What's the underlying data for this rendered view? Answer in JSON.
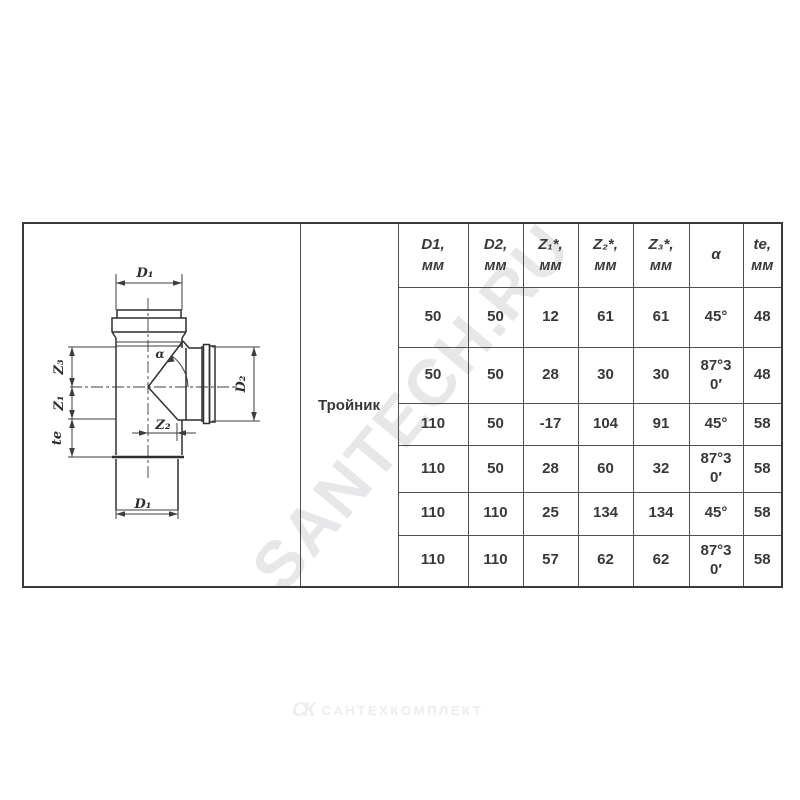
{
  "watermark": {
    "text": "SANTECH.RU",
    "color": "#e7e7ea"
  },
  "logo": {
    "glyph": "СК",
    "text": "САНТЕХКОМПЛЕКТ",
    "color": "#ededed"
  },
  "table": {
    "product_label": "Тройник",
    "columns": [
      {
        "key": "d1",
        "line1": "D1,",
        "line2": "мм"
      },
      {
        "key": "d2",
        "line1": "D2,",
        "line2": "мм"
      },
      {
        "key": "z1",
        "line1": "Z₁*,",
        "line2": "мм"
      },
      {
        "key": "z2",
        "line1": "Z₂*,",
        "line2": "мм"
      },
      {
        "key": "z3",
        "line1": "Z₃*,",
        "line2": "мм"
      },
      {
        "key": "alpha",
        "line1": "α",
        "line2": ""
      },
      {
        "key": "te",
        "line1": "te,",
        "line2": "мм"
      }
    ],
    "rows": [
      [
        "50",
        "50",
        "12",
        "61",
        "61",
        "45°",
        "48"
      ],
      [
        "50",
        "50",
        "28",
        "30",
        "30",
        "87°30′",
        "48"
      ],
      [
        "110",
        "50",
        "-17",
        "104",
        "91",
        "45°",
        "58"
      ],
      [
        "110",
        "50",
        "28",
        "60",
        "32",
        "87°30′",
        "58"
      ],
      [
        "110",
        "110",
        "25",
        "134",
        "134",
        "45°",
        "58"
      ],
      [
        "110",
        "110",
        "57",
        "62",
        "62",
        "87°30′",
        "58"
      ]
    ]
  },
  "drawing": {
    "labels": {
      "top_diameter": "D₁",
      "bottom_diameter": "D₁",
      "branch_diameter": "D₂",
      "z3": "Z₃",
      "z1": "Z₁",
      "te": "te",
      "z2": "Z₂",
      "alpha": "α"
    }
  }
}
